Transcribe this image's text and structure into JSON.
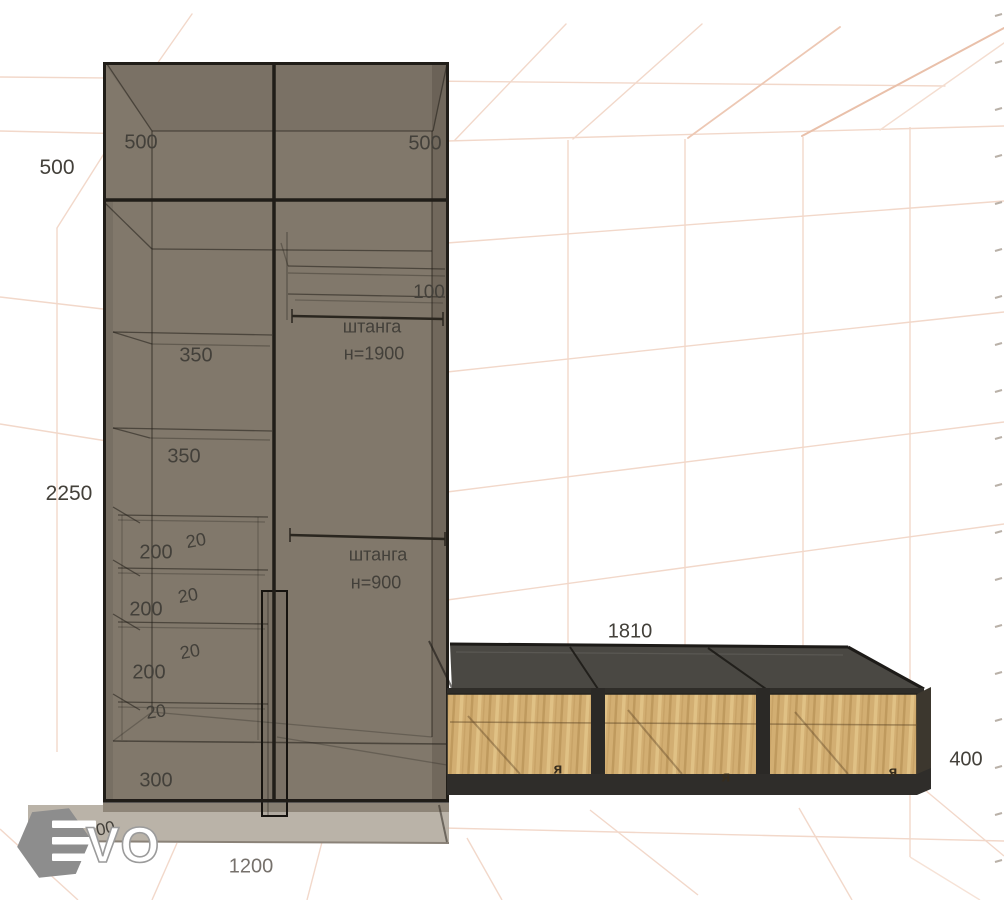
{
  "wardrobe": {
    "dim_mezzanine_height": "500",
    "dim_total_height": "2250",
    "dim_mezzanine_left": "500",
    "dim_mezzanine_right": "500",
    "dim_top_shelf_gap": "100",
    "rod_upper": {
      "name": "штанга",
      "height": "н=1900"
    },
    "rod_lower": {
      "name": "штанга",
      "height": "н=900"
    },
    "dim_shelf_gap_1": "350",
    "dim_shelf_gap_2": "350",
    "dim_drawer_1": "200",
    "dim_drawer_2": "200",
    "dim_drawer_3": "200",
    "dim_gap_1": "20",
    "dim_gap_2": "20",
    "dim_gap_3": "20",
    "dim_gap_4": "20",
    "dim_bottom_gap": "300",
    "dim_plinth_height": "100",
    "dim_width": "1200"
  },
  "bench": {
    "dim_width": "1810",
    "dim_height": "400",
    "marks": [
      "я",
      "я",
      "я"
    ]
  },
  "logo": {
    "letters": "VO"
  },
  "colors": {
    "wardrobe_body": "#81786b",
    "bench_top": "#4a4843",
    "bench_wood": "#d2ae72",
    "grid_line": "#f2d8ca",
    "dimension_text": "#43403a"
  }
}
